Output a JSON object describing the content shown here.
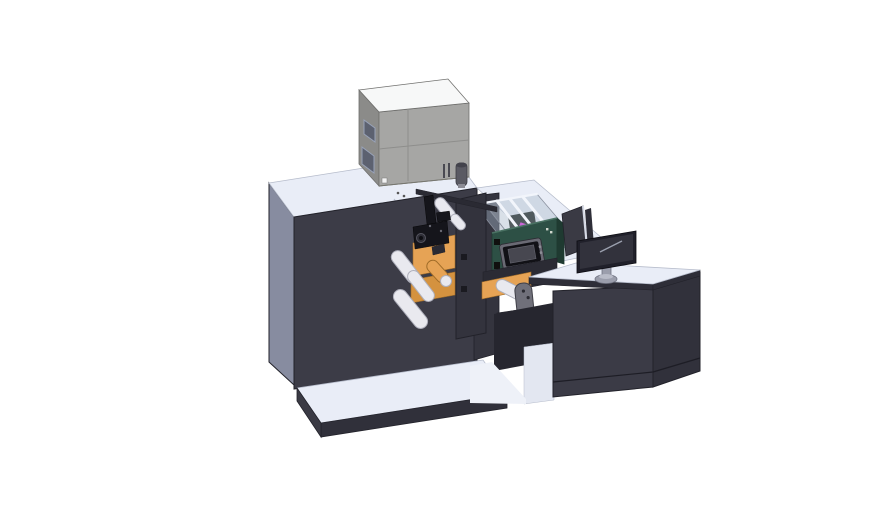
{
  "scene": {
    "background": "#ffffff",
    "object": "cad-render-label-press-line-with-printer-unit-web-mechanism-hmi-and-operator-desk"
  },
  "colors": {
    "bg": "#ffffff",
    "outline": "#22222a",
    "surface_top": "#e9edf7",
    "surface_edge": "#b6bccb",
    "cabinet_front": "#3c3c47",
    "cabinet_side": "#878ca0",
    "plate_skirt": "#30303a",
    "plate_side": "#3a3a44",
    "column": "#34343e",
    "box_left": "#8b8b89",
    "box_front": "#a6a6a4",
    "box_top": "#f7f8f8",
    "box_edge": "#6f6f6d",
    "box_window": "#5c6170",
    "box_window_edge": "#98a2b8",
    "box_seam": "#8e8e8c",
    "vent": "#4a4a52",
    "orange": "#e6a355",
    "orange_dark": "#d4923f",
    "orange_edge": "#a06c28",
    "roller": "#e9e9ef",
    "roller_shade": "#aeafbb",
    "black_part": "#15151b",
    "dark_part": "#2a2a33",
    "rail": "#2a2a33",
    "plate": "#33333d",
    "teal": "#2d5045",
    "teal_dark": "#1f3a31",
    "teal_light": "#4a7263",
    "hmi_frame": "#6a6a74",
    "hmi_bezel": "#111116",
    "hmi_screen": "#474750",
    "enclosure_fill": "rgba(186,198,214,0.55)",
    "enclosure_wall": "rgba(158,172,190,0.45)",
    "enclosure_edge": "#8a909e",
    "rib": "#f2f5fb",
    "magenta": "#cb66d8",
    "interior_dark": "#3a4446",
    "monitor_bezel": "#20202a",
    "monitor_screen": "#32323c",
    "monitor_hl": "#9aa0ae",
    "stand": "#9b9eac",
    "fin": "#3a3a44",
    "fin_edge": "#d6dae6",
    "desk_front": "#3b3b46",
    "desk_side": "#31313b",
    "desk_band": "#2e2e38",
    "kick_line": "#1d1d25",
    "shadow_zone": "#26262f",
    "interior_white": "#e3e7f1",
    "floor_white": "#eef1f8",
    "bridge_base": "#2b2b34",
    "beam": "#2c2c35",
    "bracket": "#70707a",
    "cylinder": "#5a5a63",
    "cylinder_cap": "#43434c"
  },
  "parts": [
    "main-cabinet",
    "base-plate",
    "printer-unit",
    "signal-cylinder",
    "web-guide-mechanism",
    "unwind-rollers",
    "label-web",
    "transparent-enclosure",
    "hmi-control-box",
    "connecting-bridge",
    "operator-desk",
    "desk-monitor",
    "divider-panel"
  ]
}
